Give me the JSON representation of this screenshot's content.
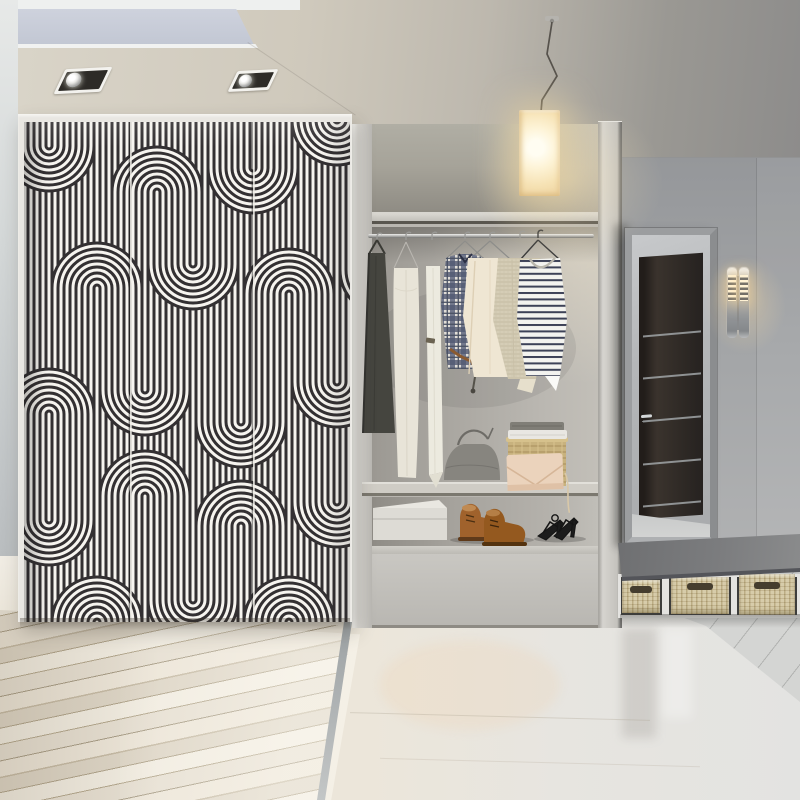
{
  "scene": {
    "description": "Modern hallway interior: wardrobe with black-and-white geometric curved-stripe doors, open closet niche with clothes and shoes, glowing pendant lamp, full-length mirror reflecting a dark door, chrome wall sconce, bench with wicker baskets, whitewashed wood and glossy tile floors",
    "style": "interior photo render"
  },
  "palette": {
    "pattern_dark": "#333032",
    "pattern_light": "#f6f4ef",
    "ceiling": "#cfc9bc",
    "ceiling_panel": "#c8ccd7",
    "wall_right": "#a3a5a7",
    "unit_gray": "#c4c2bd",
    "lamp_glow": "#fdf3d6",
    "wood_floor": "#e8e1d3",
    "tile_floor": "#e9e5db",
    "bench_seat": "#7b7c7e",
    "basket_tan": "#d2c59e",
    "door_reflection": "#2e2925"
  },
  "ceiling": {
    "spotlights": 2,
    "recessed_panel": "pale blue-grey inset panel, top left"
  },
  "wardrobe": {
    "doors": 3,
    "pattern": "vertical pinstripes with 180-degree tube bends forming S-curves",
    "arc_motifs_up": 11,
    "arc_motifs_down": 8
  },
  "pendant_lamp": {
    "shade": "rectangular cream glass, lit",
    "cord": "dark zigzag wire"
  },
  "closet": {
    "rod": "chrome hanging rail",
    "clothes": [
      {
        "name": "dark apron dress",
        "color": "#45453f"
      },
      {
        "name": "cream slip dress",
        "color": "#e8e4d8"
      },
      {
        "name": "white long garment",
        "color": "#eceadf"
      },
      {
        "name": "navy plaid shirt",
        "color": "#47506b"
      },
      {
        "name": "ivory robe",
        "color": "#efe6d3"
      },
      {
        "name": "oatmeal knit sweater",
        "color": "#d5cdb6"
      },
      {
        "name": "navy striped top",
        "color": "#f2f2ee"
      }
    ],
    "shelf_items": [
      {
        "name": "grey handbag",
        "color": "#87857f"
      },
      {
        "name": "wicker basket with folded cloths",
        "color": "#c8b27e"
      },
      {
        "name": "blush envelope clutch",
        "color": "#ebd3bc"
      }
    ],
    "floor_items": [
      {
        "name": "white shoe box",
        "color": "#dddbd5"
      },
      {
        "name": "brown leather chukka boots",
        "color": "#a0622c"
      },
      {
        "name": "black strappy heels",
        "color": "#1a1a1a"
      }
    ]
  },
  "mirror": {
    "frame": "grey aluminium",
    "reflection": "dark wenge door with aluminium inlay strips and chrome handle"
  },
  "sconce": {
    "style": "twin chrome cylinders, lit slots",
    "cylinders": 2
  },
  "bench": {
    "seat": "grey slab",
    "baskets": 3,
    "basket_material": "woven tan wicker"
  },
  "floor": {
    "left": "whitewashed diagonal wood planks",
    "right": "glossy cream tile",
    "mat": "grey tile inlay with seams"
  }
}
